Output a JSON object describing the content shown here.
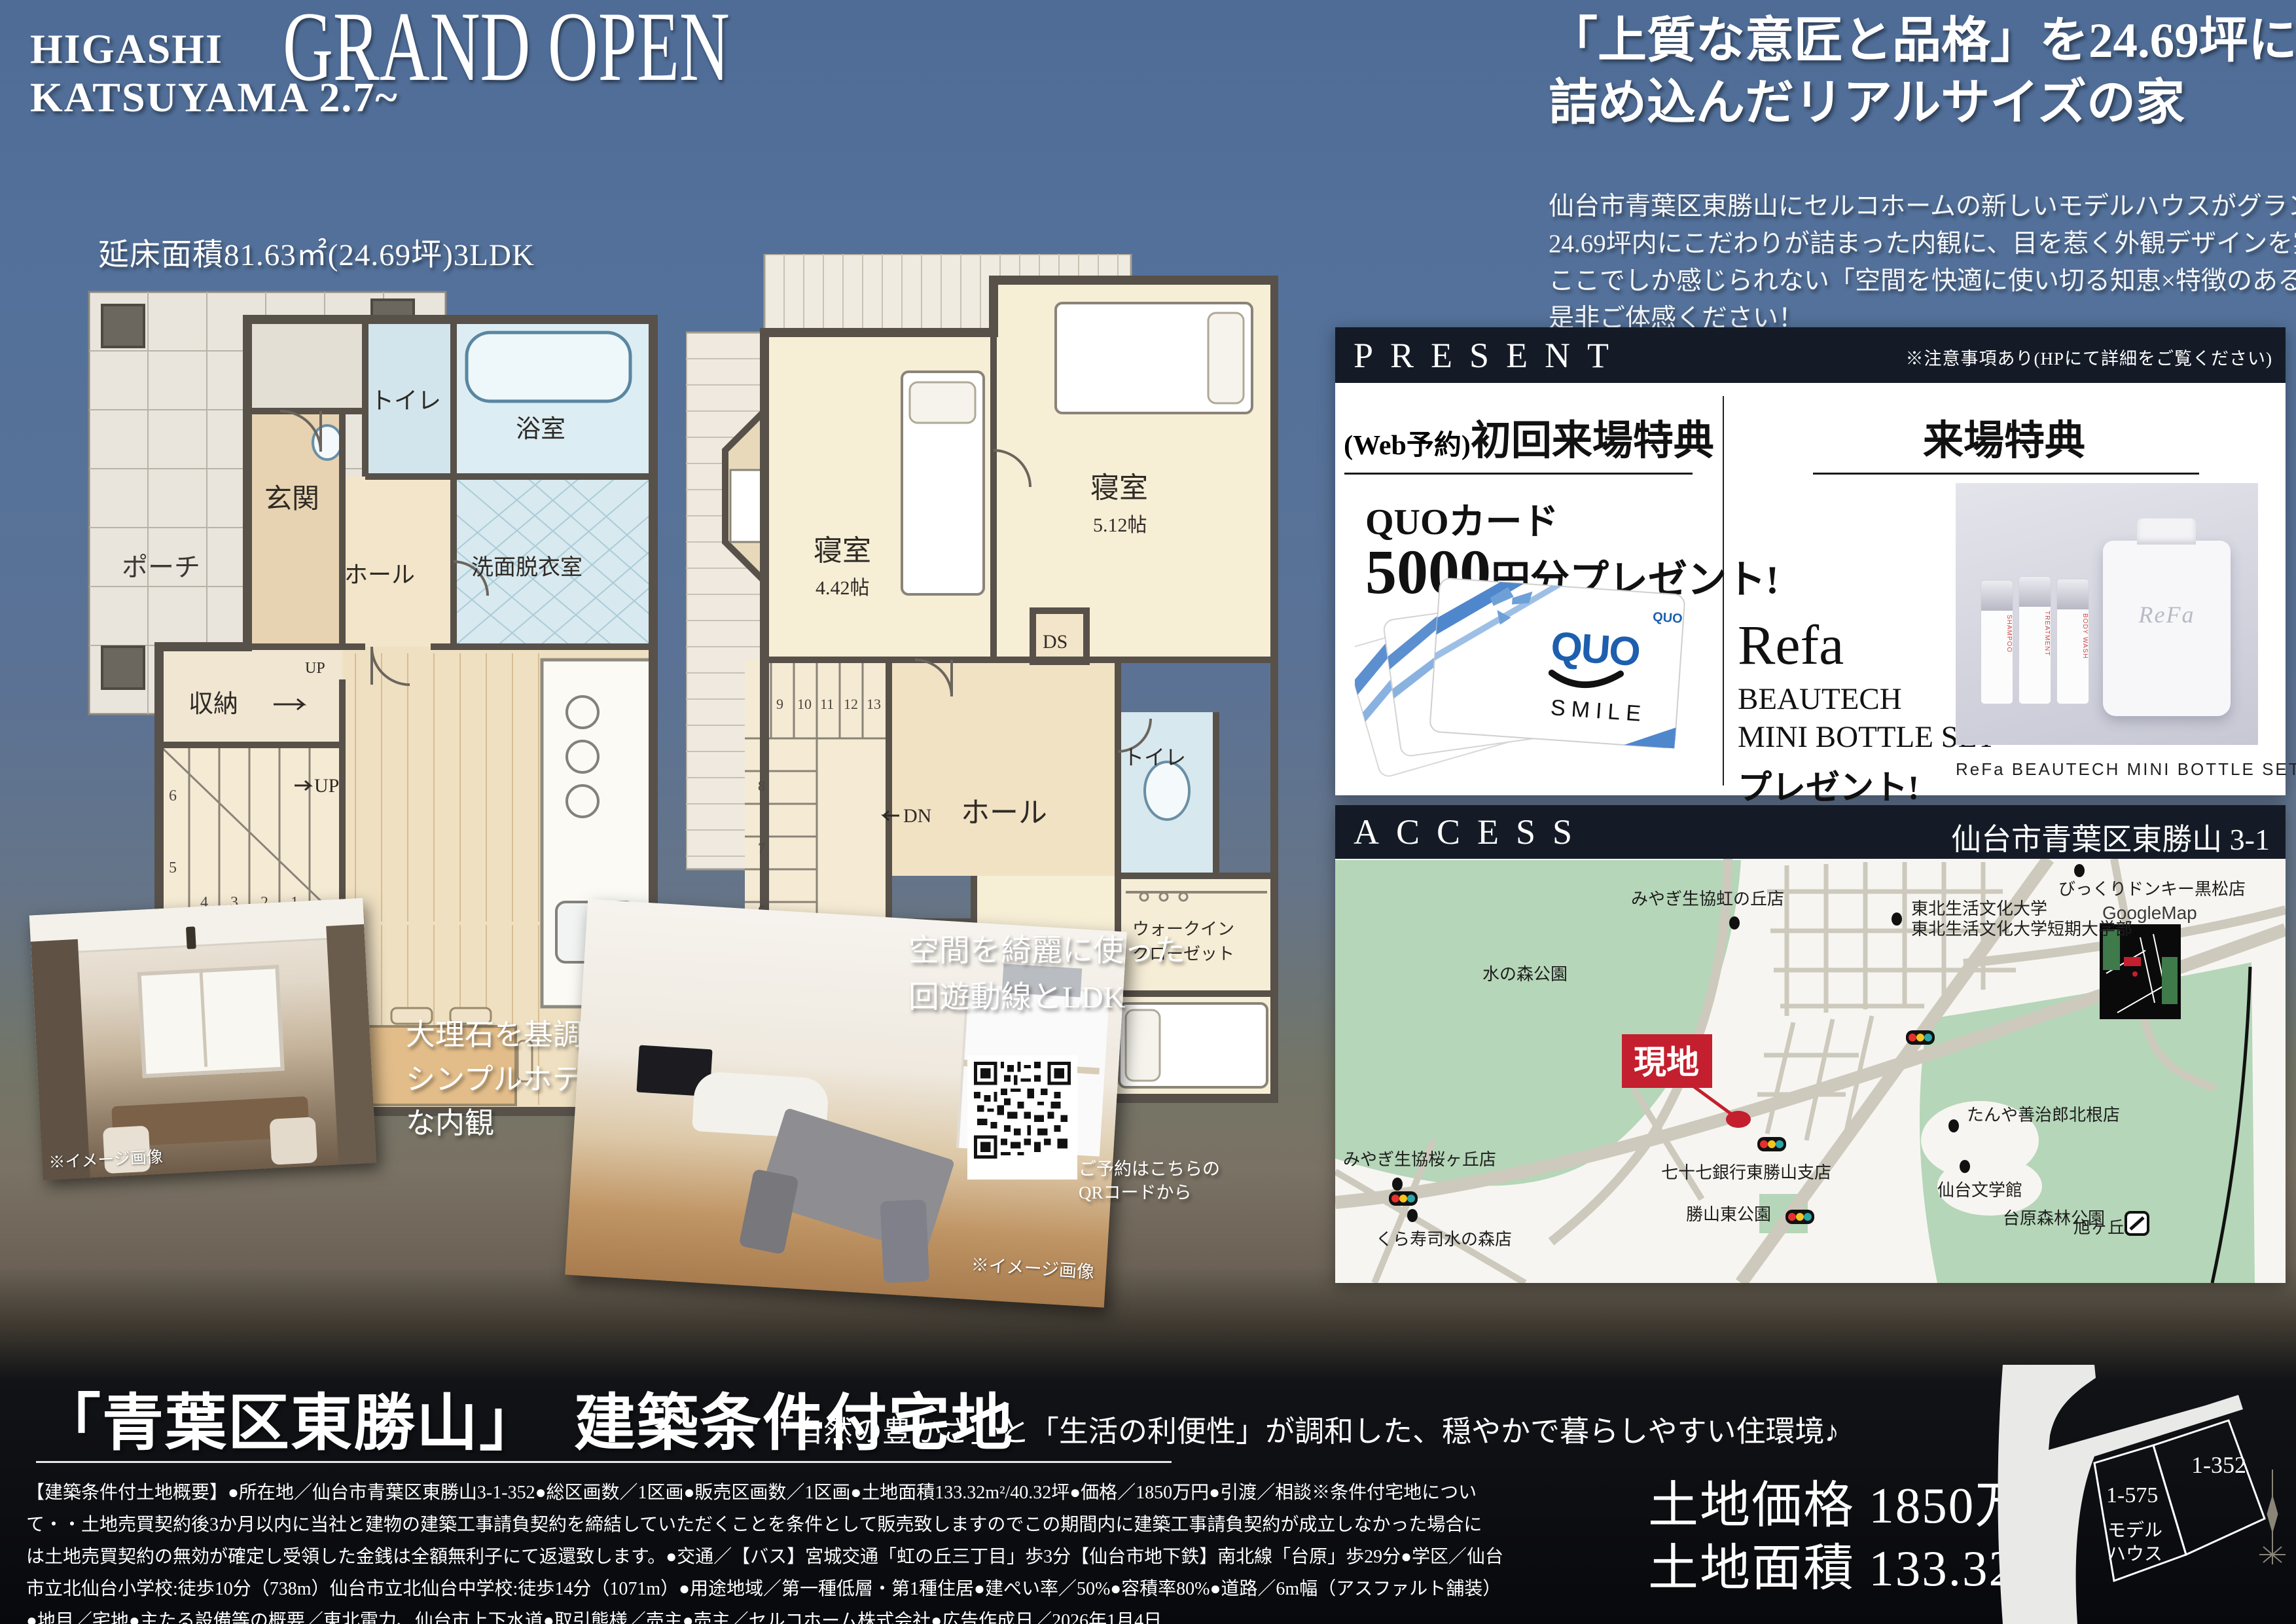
{
  "colors": {
    "accent_navy": "#141b26",
    "site_red": "#c41f2e",
    "map_green": "#b5d6b8",
    "quo_blue": "#1d5fae",
    "bg_top_blue": "#53719a",
    "bg_bottom_black": "#08090d"
  },
  "header": {
    "brand_line1": "HIGASHI",
    "brand_line2": "KATSUYAMA 2.7~",
    "title": "GRAND OPEN",
    "headline_line1": "「上質な意匠と品格」を24.69坪に",
    "headline_line2": "詰め込んだリアルサイズの家",
    "lead_lines": [
      "仙台市青葉区東勝山にセルコホームの新しいモデルハウスがグランドオープン🎉",
      "24.69坪内にこだわりが詰まった内観に、目を惹く外観デザインを実現。",
      "ここでしか感じられない「空間を快適に使い切る知恵×特徴のある外観」を",
      "是非ご体感ください！"
    ]
  },
  "floorplan": {
    "area_label": "延床面積81.63㎡(24.69坪)3LDK",
    "f1": {
      "porch": "ポーチ",
      "entrance": "玄関",
      "hall": "ホール",
      "toilet": "トイレ",
      "bath": "浴室",
      "washroom": "洗面脱衣室",
      "storage": "収納",
      "up": "UP",
      "ldk": "LDK",
      "ldk_size": "15.62帖",
      "ps": "PS",
      "stairs": [
        "6",
        "5",
        "4",
        "3",
        "2",
        "1"
      ]
    },
    "f2": {
      "bedroom": "寝室",
      "b1_size": "4.42帖",
      "b2_size": "5.12帖",
      "b3_size": "7.50帖",
      "hall": "ホール",
      "dn": "DN",
      "toilet": "トイレ",
      "wic_line1": "ウォークイン",
      "wic_line2": "クローゼット",
      "void": "吹抜",
      "ds": "DS",
      "stairs": [
        "6",
        "7",
        "8",
        "9",
        "10",
        "11",
        "12",
        "13"
      ]
    }
  },
  "present": {
    "header": "PRESENT",
    "note": "※注意事項あり(HPにて詳細をご覧ください)",
    "web_tag": "(Web予約)",
    "first_visit_title": "初回来場特典",
    "quo_item": "QUOカード",
    "quo_amount": "5000",
    "quo_amount_suffix": "円分プレゼント!",
    "quo_logo": "QUO",
    "quo_smile": "SMILE",
    "visit_title": "来場特典",
    "refa_brand": "Refa",
    "refa_line1": "BEAUTECH",
    "refa_line2": "MINI BOTTLE SET",
    "refa_line3": "プレゼント!",
    "refa_script": "ReFa",
    "refa_caption": "ReFa BEAUTECH MINI BOTTLE SET"
  },
  "access": {
    "header": "ACCESS",
    "address": "仙台市青葉区東勝山 3-1",
    "map": {
      "mizunomori_park": "水の森公園",
      "coop_nijinooka": "みやぎ生協虹の丘店",
      "bikkuri_donkey": "びっくりドンキー黒松店",
      "univ_line1": "東北生活文化大学",
      "univ_line2": "東北生活文化大学短期大学部",
      "googlemap": "GoogleMap",
      "site": "現地",
      "bank": "七十七銀行東勝山支店",
      "katsuyama_park": "勝山東公園",
      "coop_sakuragaoka": "みやぎ生協桜ヶ丘店",
      "kurazushi": "くら寿司水の森店",
      "tanya": "たんや善治郎北根店",
      "bungakukan": "仙台文学館",
      "dainohara_park": "台原森林公園",
      "asahigaoka": "旭ヶ丘"
    }
  },
  "photos": {
    "left_caption_lines": [
      "大理石を基調とした",
      "シンプルホテルライク",
      "な内観"
    ],
    "right_caption_lines": [
      "空間を綺麗に使った",
      "回遊動線とLDK"
    ],
    "image_note": "※イメージ画像",
    "qr_caption_line1": "ご予約はこちらの",
    "qr_caption_line2": "QRコードから"
  },
  "bottom": {
    "title": "「青葉区東勝山」　建築条件付宅地",
    "subtitle": "「自然の豊かさ」と「生活の利便性」が調和した、穏やかで暮らしやすい住環境♪",
    "legal_lines": [
      "【建築条件付土地概要】●所在地／仙台市青葉区東勝山3-1-352●総区画数／1区画●販売区画数／1区画●土地面積133.32m²/40.32坪●価格／1850万円●引渡／相談※条件付宅地につい",
      "て・・土地売買契約後3か月以内に当社と建物の建築工事請負契約を締結していただくことを条件として販売致しますのでこの期間内に建築工事請負契約が成立しなかった場合に",
      "は土地売買契約の無効が確定し受領した金銭は全額無利子にて返還致します。●交通／【バス】宮城交通「虹の丘三丁目」歩3分【仙台市地下鉄】南北線「台原」歩29分●学区／仙台",
      "市立北仙台小学校:徒歩10分（738m）仙台市立北仙台中学校:徒歩14分（1071m）●用途地域／第一種低層・第1種住居●建ぺい率／50%●容積率80%●道路／6m幅（アスファルト舗装）",
      "●地目／宅地●主たる設備等の概要／東北電力、仙台市上下水道●取引態様／売主●売主／セルコホーム株式会社●広告作成日／2026年1月4日"
    ],
    "land_price": "土地価格 1850万円",
    "land_area": "土地面積 133.32㎡",
    "lot_a": "1-575",
    "lot_a_sub1": "モデル",
    "lot_a_sub2": "ハウス",
    "lot_b": "1-352"
  }
}
